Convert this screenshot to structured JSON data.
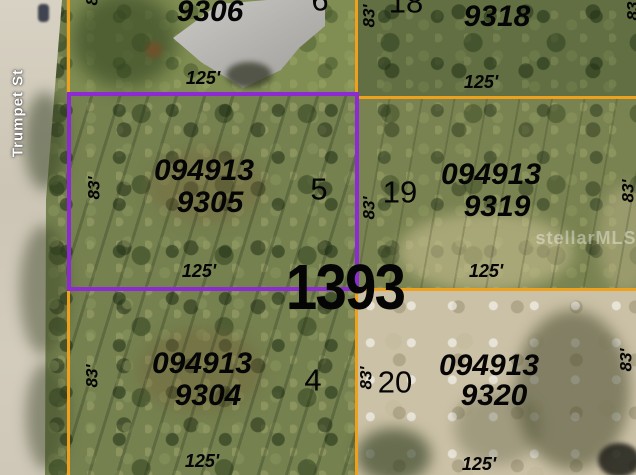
{
  "street": {
    "name": "Trumpet St"
  },
  "watermark": "stellarMLS",
  "block_ref": "1393",
  "dims": {
    "frontage": "125'",
    "depth": "83'"
  },
  "parcels": {
    "top_left": {
      "id": "9306",
      "lot": "6"
    },
    "top_right": {
      "id": "9318",
      "lot": "18"
    },
    "mid_left": {
      "id_line1": "094913",
      "id_line2": "9305",
      "lot": "5"
    },
    "mid_right": {
      "id_line1": "094913",
      "id_line2": "9319",
      "lot": "19"
    },
    "bottom_left": {
      "id_line1": "094913",
      "id_line2": "9304",
      "lot": "4"
    },
    "bottom_right": {
      "id_line1": "094913",
      "id_line2": "9320",
      "lot": "20"
    }
  },
  "colors": {
    "boundary_line": "#EFA11B",
    "highlight_boundary": "#8D2BD3",
    "label_text": "#050505",
    "street_text": "#FFFFFF"
  }
}
